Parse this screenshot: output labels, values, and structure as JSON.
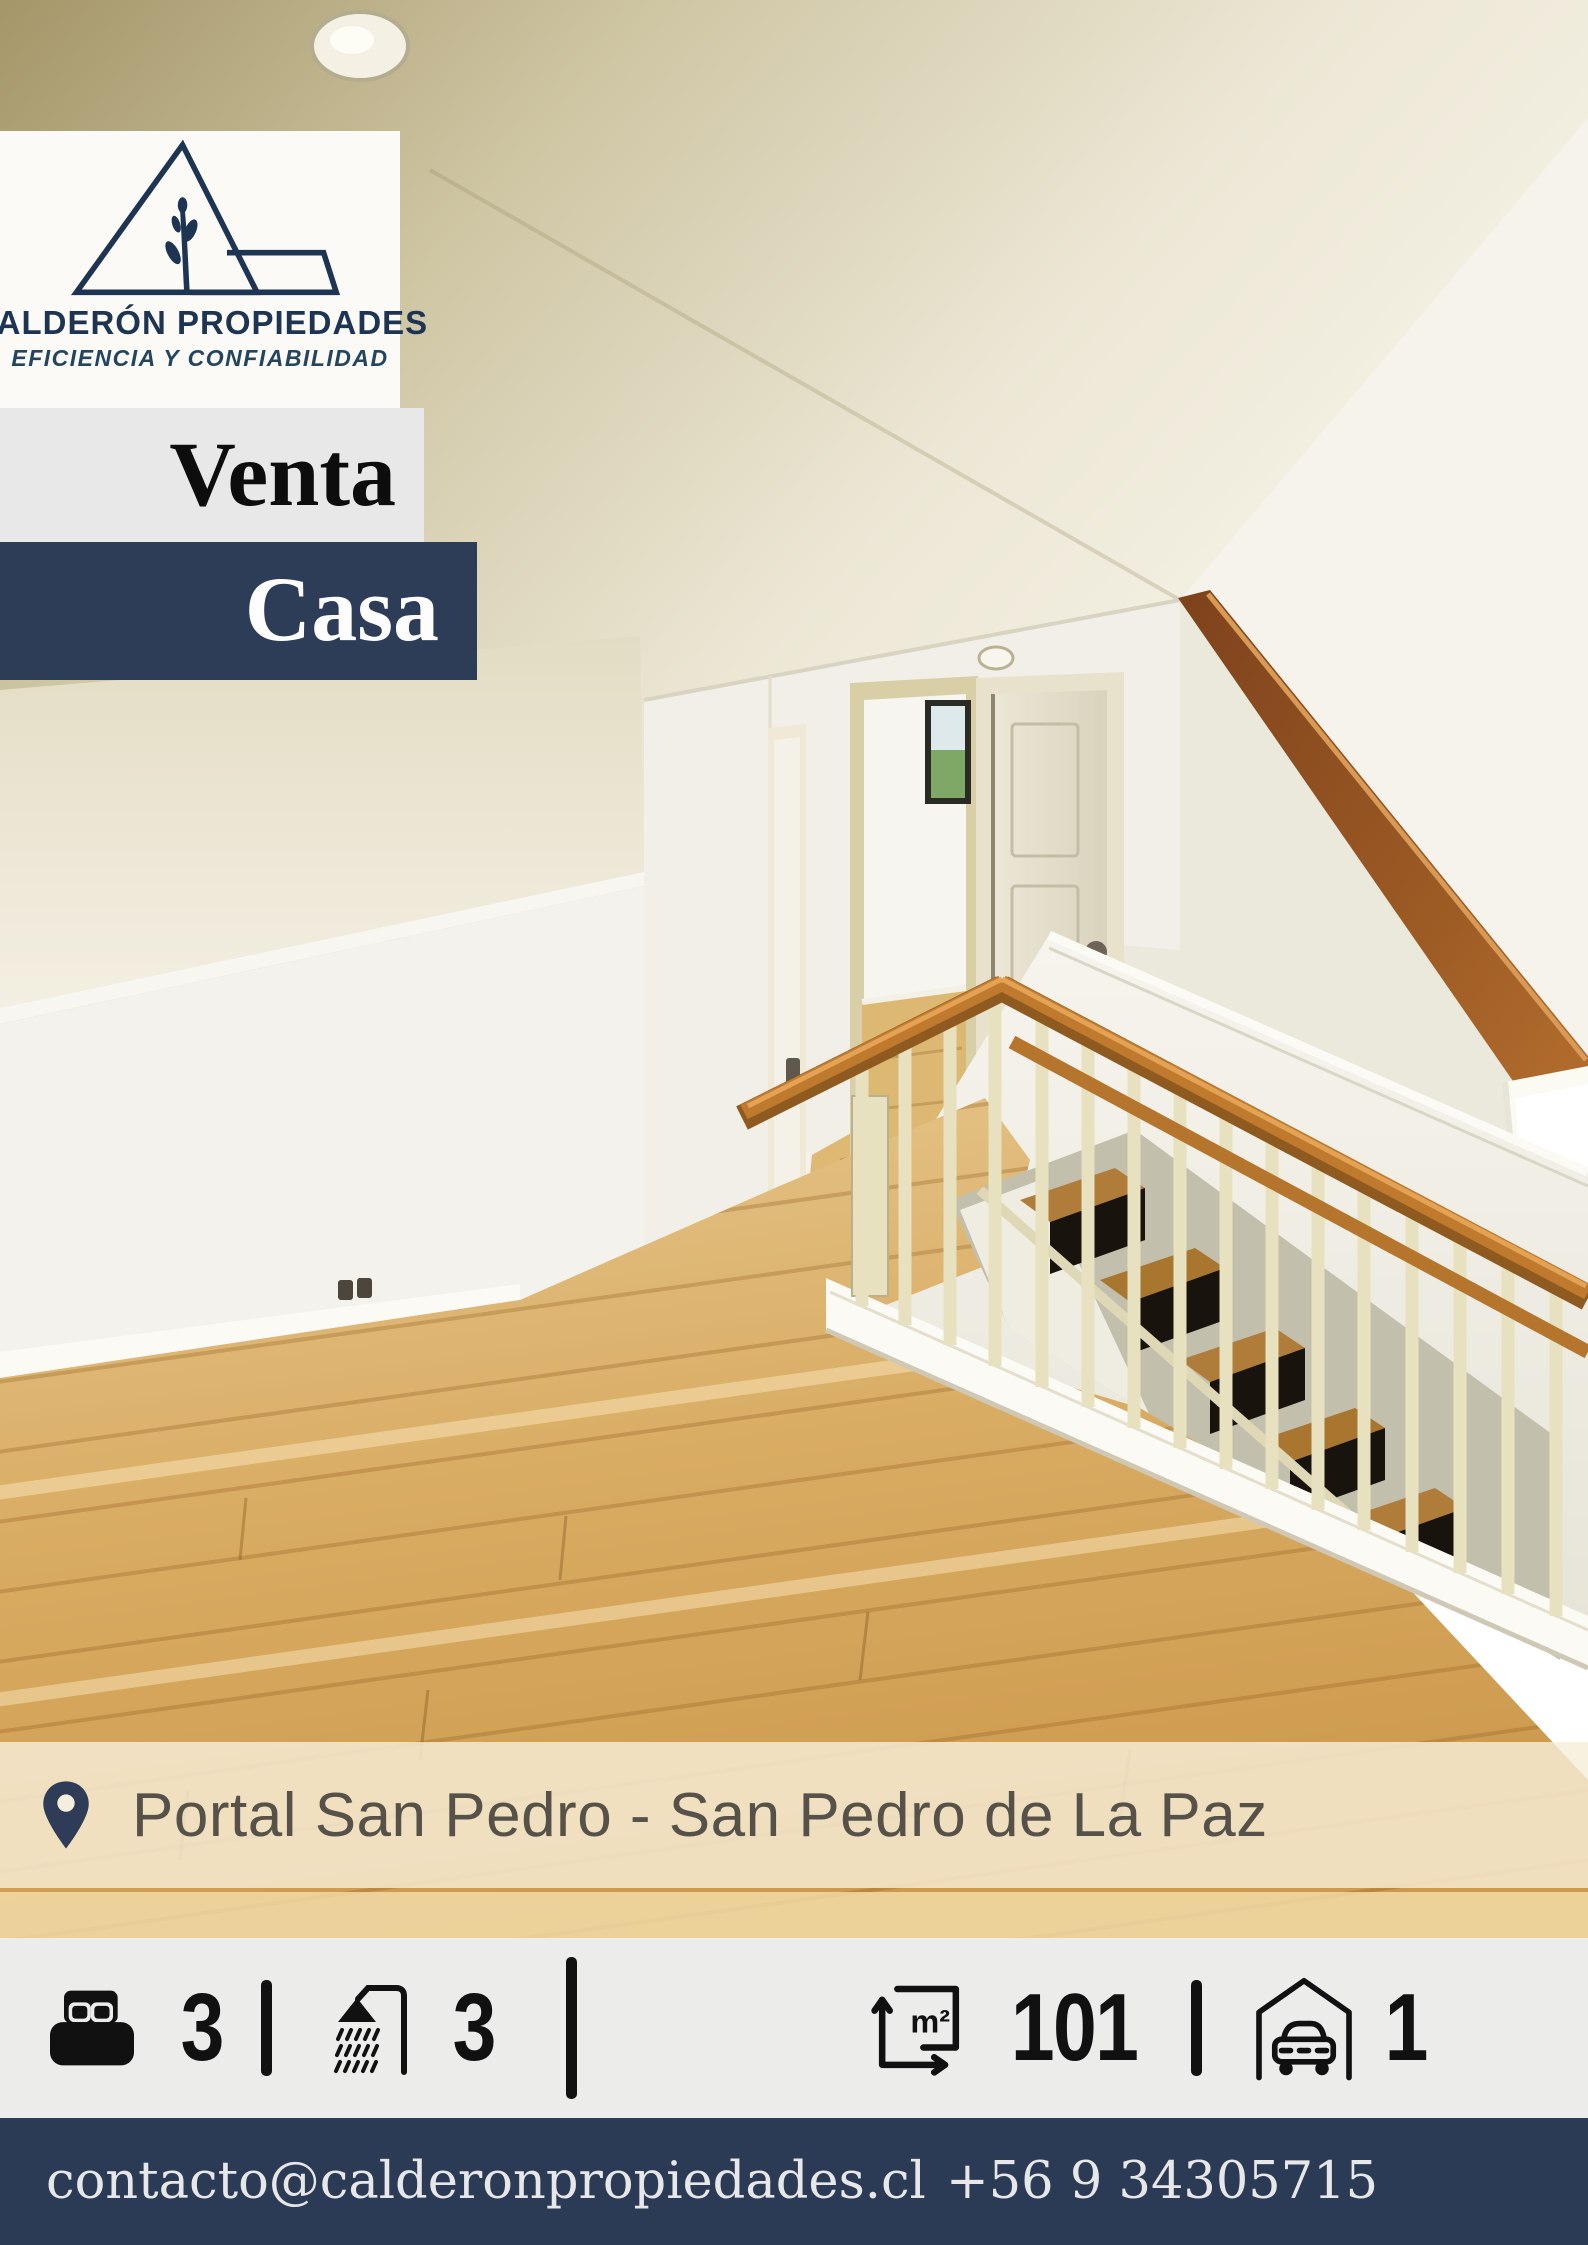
{
  "brand": {
    "name": "CALDERÓN PROPIEDADES",
    "tagline": "EFICIENCIA Y CONFIABILIDAD",
    "logo_icon": "triangle-house-plant-logo"
  },
  "listing": {
    "operation": "Venta",
    "property_type": "Casa"
  },
  "location": {
    "icon": "location-pin-icon",
    "text": "Portal San Pedro - San Pedro de La Paz"
  },
  "stats": {
    "items": [
      {
        "name": "bedrooms",
        "icon": "bed-icon",
        "value": "3"
      },
      {
        "name": "bathrooms",
        "icon": "shower-icon",
        "value": "3"
      },
      {
        "name": "area",
        "icon": "square-meters-icon",
        "unit": "m²",
        "value": "101"
      },
      {
        "name": "parking",
        "icon": "garage-icon",
        "value": "1"
      }
    ]
  },
  "footer": {
    "email": "contacto@calderonpropiedades.cl",
    "phone": "+56 9 34305715"
  },
  "colors": {
    "navy": "#2d3c57",
    "logo_navy": "#1d3553",
    "ribbon_gray": "#e9e8e8",
    "stats_bg": "#ececeb",
    "footer_navy": "#2b3a55",
    "location_overlay": "rgba(248,238,216,0.82)",
    "wood_floor": "#d8ab62",
    "handrail_wood": "#c07a2e",
    "beam_wood": "#8a4a22"
  }
}
